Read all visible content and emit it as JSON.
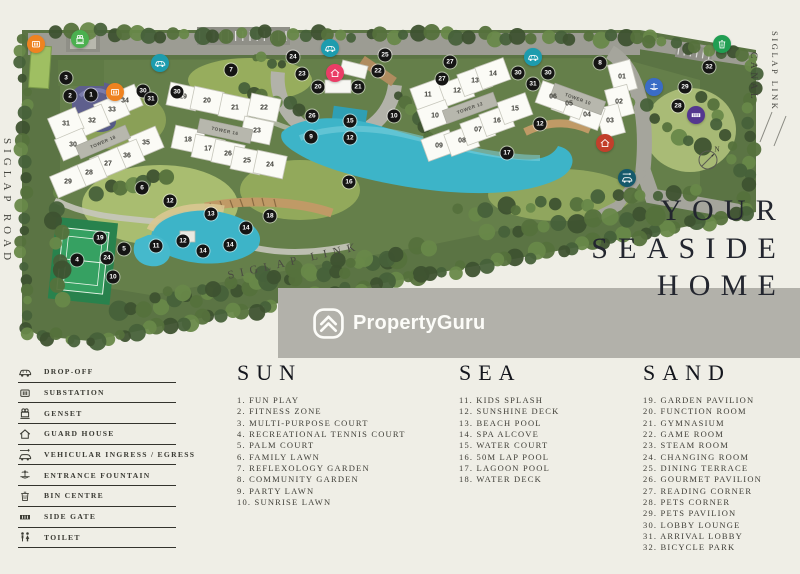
{
  "map": {
    "labels": {
      "left_road": "SIGLAP ROAD",
      "canal": "CANAL",
      "right_link": "SIGLAP LINK",
      "bottom_link": "SIGLAP LINK"
    },
    "compass": {
      "x": 708,
      "y": 158,
      "label": "N"
    },
    "towers": [
      {
        "label": "TOWER 18",
        "x": 103,
        "y": 142,
        "angle": -23,
        "units": [
          {
            "n": "34",
            "x": 125,
            "y": 101
          },
          {
            "n": "33",
            "x": 112,
            "y": 110
          },
          {
            "n": "32",
            "x": 92,
            "y": 121
          },
          {
            "n": "31",
            "x": 66,
            "y": 124
          },
          {
            "n": "30",
            "x": 73,
            "y": 145
          },
          {
            "n": "35",
            "x": 146,
            "y": 143
          },
          {
            "n": "36",
            "x": 127,
            "y": 156
          },
          {
            "n": "27",
            "x": 108,
            "y": 164
          },
          {
            "n": "28",
            "x": 89,
            "y": 173
          },
          {
            "n": "29",
            "x": 68,
            "y": 182
          }
        ]
      },
      {
        "label": "TOWER 16",
        "x": 225,
        "y": 131,
        "angle": 12,
        "units": [
          {
            "n": "19",
            "x": 183,
            "y": 97
          },
          {
            "n": "20",
            "x": 207,
            "y": 101
          },
          {
            "n": "21",
            "x": 235,
            "y": 108
          },
          {
            "n": "22",
            "x": 264,
            "y": 108
          },
          {
            "n": "23",
            "x": 257,
            "y": 131
          },
          {
            "n": "18",
            "x": 188,
            "y": 140
          },
          {
            "n": "17",
            "x": 208,
            "y": 149
          },
          {
            "n": "26",
            "x": 228,
            "y": 154
          },
          {
            "n": "25",
            "x": 247,
            "y": 161
          },
          {
            "n": "24",
            "x": 270,
            "y": 165
          }
        ]
      },
      {
        "label": "TOWER 12",
        "x": 470,
        "y": 108,
        "angle": -20,
        "units": [
          {
            "n": "11",
            "x": 428,
            "y": 95
          },
          {
            "n": "12",
            "x": 457,
            "y": 91
          },
          {
            "n": "13",
            "x": 475,
            "y": 81
          },
          {
            "n": "14",
            "x": 493,
            "y": 74
          },
          {
            "n": "10",
            "x": 435,
            "y": 116
          },
          {
            "n": "09",
            "x": 439,
            "y": 146
          },
          {
            "n": "08",
            "x": 462,
            "y": 141
          },
          {
            "n": "07",
            "x": 478,
            "y": 130
          },
          {
            "n": "16",
            "x": 497,
            "y": 121
          },
          {
            "n": "15",
            "x": 515,
            "y": 109
          }
        ]
      },
      {
        "label": "TOWER 10",
        "x": 578,
        "y": 99,
        "angle": 20,
        "units": [
          {
            "n": "01",
            "x": 622,
            "y": 77,
            "a": 75
          },
          {
            "n": "02",
            "x": 619,
            "y": 102,
            "a": 75
          },
          {
            "n": "03",
            "x": 610,
            "y": 121,
            "a": 75
          },
          {
            "n": "04",
            "x": 587,
            "y": 115
          },
          {
            "n": "05",
            "x": 569,
            "y": 104
          },
          {
            "n": "06",
            "x": 553,
            "y": 97
          }
        ]
      }
    ],
    "badges": [
      {
        "n": "3",
        "x": 66,
        "y": 78
      },
      {
        "n": "2",
        "x": 70,
        "y": 96
      },
      {
        "n": "1",
        "x": 91,
        "y": 95
      },
      {
        "n": "30",
        "x": 143,
        "y": 91
      },
      {
        "n": "31",
        "x": 151,
        "y": 99
      },
      {
        "n": "30",
        "x": 177,
        "y": 92
      },
      {
        "n": "7",
        "x": 231,
        "y": 70
      },
      {
        "n": "24",
        "x": 293,
        "y": 57
      },
      {
        "n": "23",
        "x": 302,
        "y": 74
      },
      {
        "n": "20",
        "x": 318,
        "y": 87
      },
      {
        "n": "21",
        "x": 358,
        "y": 87
      },
      {
        "n": "22",
        "x": 378,
        "y": 71
      },
      {
        "n": "25",
        "x": 385,
        "y": 55
      },
      {
        "n": "26",
        "x": 312,
        "y": 116
      },
      {
        "n": "9",
        "x": 311,
        "y": 137
      },
      {
        "n": "15",
        "x": 350,
        "y": 121
      },
      {
        "n": "12",
        "x": 350,
        "y": 138
      },
      {
        "n": "10",
        "x": 394,
        "y": 116
      },
      {
        "n": "16",
        "x": 349,
        "y": 182
      },
      {
        "n": "27",
        "x": 450,
        "y": 62
      },
      {
        "n": "27",
        "x": 442,
        "y": 79
      },
      {
        "n": "30",
        "x": 518,
        "y": 73
      },
      {
        "n": "30",
        "x": 548,
        "y": 73
      },
      {
        "n": "31",
        "x": 533,
        "y": 84
      },
      {
        "n": "8",
        "x": 600,
        "y": 63
      },
      {
        "n": "12",
        "x": 540,
        "y": 124
      },
      {
        "n": "17",
        "x": 507,
        "y": 153
      },
      {
        "n": "29",
        "x": 685,
        "y": 87
      },
      {
        "n": "28",
        "x": 678,
        "y": 106
      },
      {
        "n": "32",
        "x": 709,
        "y": 67
      },
      {
        "n": "6",
        "x": 142,
        "y": 188
      },
      {
        "n": "12",
        "x": 170,
        "y": 201
      },
      {
        "n": "13",
        "x": 211,
        "y": 214
      },
      {
        "n": "4",
        "x": 77,
        "y": 260
      },
      {
        "n": "19",
        "x": 100,
        "y": 238
      },
      {
        "n": "5",
        "x": 124,
        "y": 249
      },
      {
        "n": "24",
        "x": 107,
        "y": 258
      },
      {
        "n": "10",
        "x": 113,
        "y": 277
      },
      {
        "n": "11",
        "x": 156,
        "y": 246
      },
      {
        "n": "12",
        "x": 183,
        "y": 241
      },
      {
        "n": "14",
        "x": 203,
        "y": 251
      },
      {
        "n": "14",
        "x": 230,
        "y": 245
      },
      {
        "n": "14",
        "x": 246,
        "y": 228
      },
      {
        "n": "18",
        "x": 270,
        "y": 216
      }
    ],
    "icons": [
      {
        "type": "substation",
        "name": "substation",
        "x": 36,
        "y": 44,
        "color": "#ef8320"
      },
      {
        "type": "genset",
        "name": "genset",
        "x": 80,
        "y": 39,
        "color": "#4bb04f"
      },
      {
        "type": "car",
        "name": "drop-off",
        "x": 160,
        "y": 63,
        "color": "#1d9cae"
      },
      {
        "type": "substation",
        "name": "substation",
        "x": 115,
        "y": 92,
        "color": "#ef8320"
      },
      {
        "type": "car",
        "name": "drop-off",
        "x": 330,
        "y": 48,
        "color": "#1d9cae"
      },
      {
        "type": "house",
        "name": "guard-house",
        "x": 335,
        "y": 73,
        "color": "#ea3d66"
      },
      {
        "type": "car",
        "name": "drop-off",
        "x": 533,
        "y": 57,
        "color": "#1d9cae"
      },
      {
        "type": "house",
        "name": "guard-house",
        "x": 605,
        "y": 143,
        "color": "#c23f2b"
      },
      {
        "type": "fountain",
        "name": "entrance-fountain",
        "x": 654,
        "y": 87,
        "color": "#3a6cc6"
      },
      {
        "type": "sidegate",
        "name": "side-gate",
        "x": 696,
        "y": 115,
        "color": "#54378f"
      },
      {
        "type": "bin",
        "name": "bin-centre",
        "x": 722,
        "y": 44,
        "color": "#219e52"
      },
      {
        "type": "car-arrow",
        "name": "vehicular-ingress-egress",
        "x": 627,
        "y": 178,
        "color": "#15596b"
      }
    ]
  },
  "tagline": {
    "line1": "YOUR",
    "line2": "SEASIDE",
    "line3": "HOME"
  },
  "watermark": {
    "text": "PropertyGuru"
  },
  "legend": {
    "items": [
      {
        "icon": "car",
        "label": "DROP-OFF"
      },
      {
        "icon": "substation",
        "label": "SUBSTATION"
      },
      {
        "icon": "genset",
        "label": "GENSET"
      },
      {
        "icon": "house",
        "label": "GUARD HOUSE"
      },
      {
        "icon": "car-arrow",
        "label": "VEHICULAR INGRESS / EGRESS"
      },
      {
        "icon": "fountain",
        "label": "ENTRANCE FOUNTAIN"
      },
      {
        "icon": "bin",
        "label": "BIN CENTRE"
      },
      {
        "icon": "sidegate",
        "label": "SIDE GATE"
      },
      {
        "icon": "toilet",
        "label": "TOILET"
      }
    ],
    "columns": [
      {
        "title": "SUN",
        "items": [
          "1. FUN PLAY",
          "2. FITNESS ZONE",
          "3. MULTI-PURPOSE COURT",
          "4. RECREATIONAL TENNIS COURT",
          "5. PALM COURT",
          "6. FAMILY LAWN",
          "7. REFLEXOLOGY GARDEN",
          "8. COMMUNITY GARDEN",
          "9. PARTY LAWN",
          "10. SUNRISE LAWN"
        ]
      },
      {
        "title": "SEA",
        "items": [
          "11. KIDS SPLASH",
          "12. SUNSHINE DECK",
          "13. BEACH POOL",
          "14. SPA ALCOVE",
          "15. WATER COURT",
          "16. 50M LAP POOL",
          "17. LAGOON POOL",
          "18. WATER DECK"
        ]
      },
      {
        "title": "SAND",
        "items": [
          "19. GARDEN PAVILION",
          "20. FUNCTION ROOM",
          "21. GYMNASIUM",
          "22. GAME ROOM",
          "23. STEAM ROOM",
          "24. CHANGING ROOM",
          "25. DINING TERRACE",
          "26. GOURMET PAVILION",
          "27. READING CORNER",
          "28. PETS CORNER",
          "29. PETS PAVILION",
          "30. LOBBY LOUNGE",
          "31. ARRIVAL LOBBY",
          "32. BICYCLE PARK"
        ]
      }
    ]
  },
  "colors": {
    "background": "#efeee6",
    "watermark_band": "#b2b1aa",
    "site_green": "#5b7444",
    "pool_teal": "#3db4c8",
    "badge_black": "#151514",
    "tagline_ink": "#23262f"
  }
}
